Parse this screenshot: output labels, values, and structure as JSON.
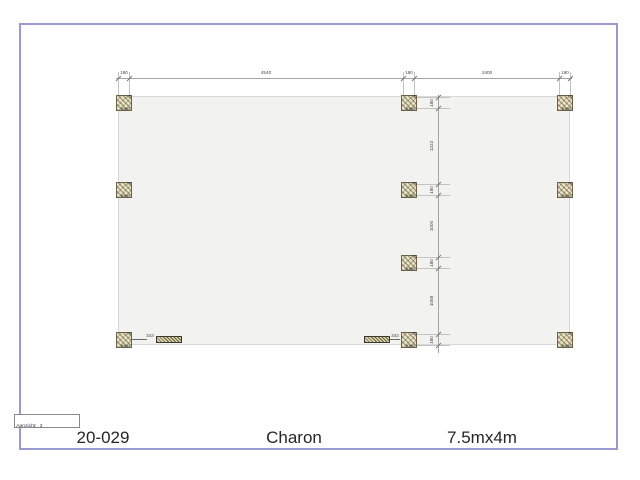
{
  "page": {
    "background": "#ffffff",
    "border_color": "#9a9ad0"
  },
  "title_block": {
    "order_number": "20-029",
    "model_name": "Charon",
    "size_label": "7.5mx4m"
  },
  "view_box": {
    "label": "Aanzicht:",
    "value": "2"
  },
  "plan": {
    "fill": "#f2f2f1",
    "outline": "#d8d8d8",
    "dimension_line_color": "#a3a3a3",
    "dimension_text_color": "#4a4a4a",
    "post_fill": "#e9e3c6",
    "horizontal_dims": [
      "180",
      "4540",
      "180",
      "2400",
      "180"
    ],
    "vertical_dims": [
      "180",
      "1222",
      "180",
      "1000",
      "180",
      "1058",
      "180"
    ],
    "spacer_dims": [
      {
        "side": "left",
        "value": "343"
      },
      {
        "side": "right",
        "value": "343"
      }
    ],
    "posts": [
      {
        "col": "left",
        "row": 1,
        "number": "23",
        "size": "90x90"
      },
      {
        "col": "mid",
        "row": 1,
        "number": "23",
        "size": "90x90"
      },
      {
        "col": "right",
        "row": 1,
        "number": "23",
        "size": "90x90"
      },
      {
        "col": "left",
        "row": 2,
        "number": "24",
        "size": "90x90"
      },
      {
        "col": "mid",
        "row": 2,
        "number": "24",
        "size": "90x90"
      },
      {
        "col": "right",
        "row": 2,
        "number": "24",
        "size": "90x90"
      },
      {
        "col": "mid",
        "row": 3,
        "number": "25",
        "size": "90x90"
      },
      {
        "col": "left",
        "row": 4,
        "number": "26",
        "size": "90x90"
      },
      {
        "col": "mid",
        "row": 4,
        "number": "26",
        "size": "90x90"
      },
      {
        "col": "right",
        "row": 4,
        "number": "26",
        "size": "90x90"
      }
    ]
  }
}
